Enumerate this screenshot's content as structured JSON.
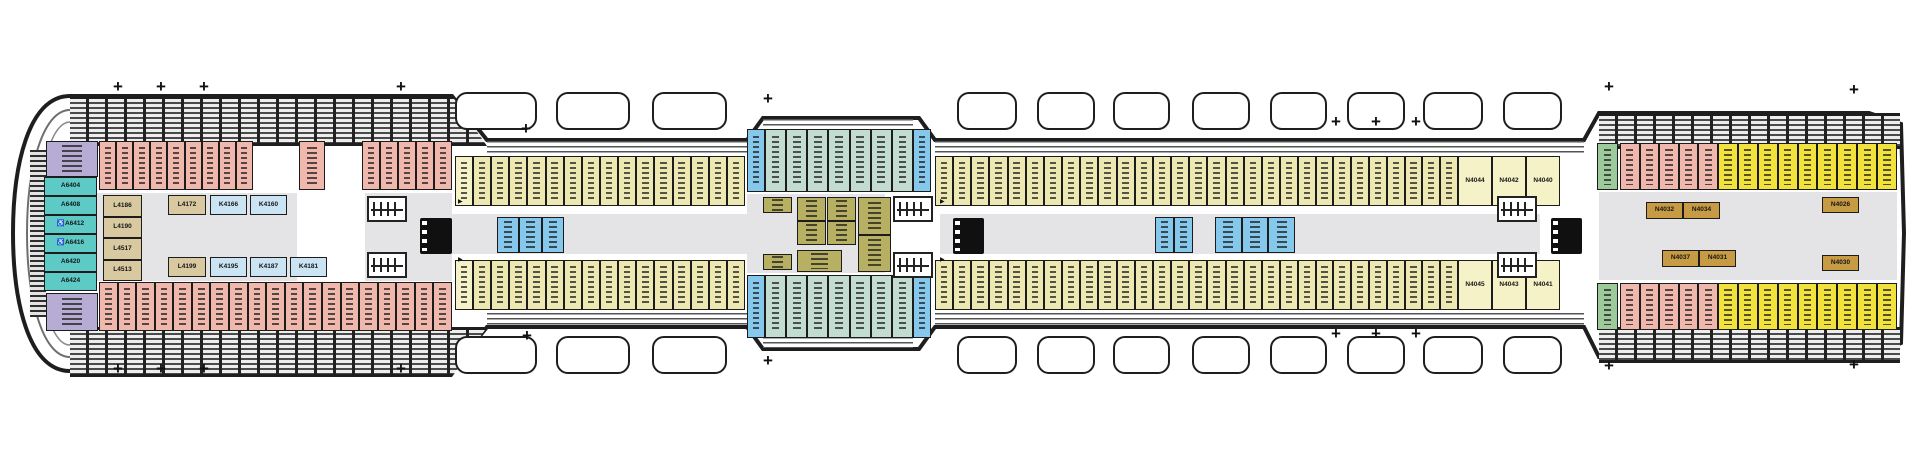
{
  "title": "ship-deck-plan",
  "colors": {
    "pink": "#F0B7AC",
    "khaki": "#EDE8B2",
    "olive": "#B7AF62",
    "tan": "#D8C9A1",
    "kblue": "#CBE4F4",
    "blue": "#86C7EC",
    "paleteal": "#C2DCD2",
    "teal": "#5ECAC6",
    "purple": "#B6ACD4",
    "yellow": "#F1E23C",
    "green": "#9CCA9A",
    "gold": "#C79B44",
    "paleyellow": "#F6F2C8",
    "outline": "#1E1E1E",
    "deck_gray": "#E4E4E6"
  },
  "plan": {
    "sections": [
      {
        "n": "purple-corner-top",
        "x": 46,
        "y": 141,
        "w": 52,
        "h": 36,
        "c": 1,
        "col": "purple"
      },
      {
        "n": "pink-top-a",
        "x": 99,
        "y": 141,
        "w": 154,
        "h": 49,
        "c": 9,
        "col": "pink"
      },
      {
        "n": "pink-top-b",
        "x": 299,
        "y": 141,
        "w": 26,
        "h": 49,
        "c": 1,
        "col": "pink"
      },
      {
        "n": "pink-top-c",
        "x": 362,
        "y": 141,
        "w": 90,
        "h": 49,
        "c": 5,
        "col": "pink"
      },
      {
        "n": "bow-suites",
        "x": 44,
        "y": 177,
        "w": 53,
        "h": 114,
        "c": 6,
        "col": "teal",
        "dir": "col",
        "labels": [
          "A6404",
          "A6408",
          "A6412",
          "A6416",
          "A6420",
          "A6424"
        ],
        "acc": [
          2,
          3
        ]
      },
      {
        "n": "purple-corner-bottom",
        "x": 46,
        "y": 293,
        "w": 52,
        "h": 38,
        "c": 1,
        "col": "purple"
      },
      {
        "n": "pink-bottom",
        "x": 99,
        "y": 282,
        "w": 353,
        "h": 49,
        "c": 19,
        "col": "pink"
      },
      {
        "n": "tan-column",
        "x": 103,
        "y": 195,
        "w": 39,
        "h": 86,
        "c": 4,
        "col": "tan",
        "dir": "col",
        "labels": [
          "L4186",
          "L4190",
          "L4517",
          "L4513"
        ]
      },
      {
        "n": "mid-row-top-1",
        "x": 168,
        "y": 195,
        "w": 38,
        "h": 20,
        "c": 1,
        "col": "tan",
        "labels": [
          "L4172"
        ]
      },
      {
        "n": "mid-row-top-2",
        "x": 210,
        "y": 195,
        "w": 37,
        "h": 20,
        "c": 1,
        "col": "kblue",
        "labels": [
          "K4166"
        ]
      },
      {
        "n": "mid-row-top-3",
        "x": 250,
        "y": 195,
        "w": 37,
        "h": 20,
        "c": 1,
        "col": "kblue",
        "labels": [
          "K4160"
        ]
      },
      {
        "n": "mid-row-bot-1",
        "x": 168,
        "y": 257,
        "w": 38,
        "h": 20,
        "c": 1,
        "col": "tan",
        "labels": [
          "L4199"
        ]
      },
      {
        "n": "mid-row-bot-2",
        "x": 210,
        "y": 257,
        "w": 37,
        "h": 20,
        "c": 1,
        "col": "kblue",
        "labels": [
          "K4195"
        ]
      },
      {
        "n": "mid-row-bot-3",
        "x": 250,
        "y": 257,
        "w": 37,
        "h": 20,
        "c": 1,
        "col": "kblue",
        "labels": [
          "K4187"
        ]
      },
      {
        "n": "mid-row-bot-4",
        "x": 290,
        "y": 257,
        "w": 37,
        "h": 20,
        "c": 1,
        "col": "kblue",
        "labels": [
          "K4181"
        ]
      },
      {
        "n": "plain-top-l",
        "x": 455,
        "y": 156,
        "w": 18,
        "h": 50,
        "c": 1,
        "col": "paleyellow"
      },
      {
        "n": "khaki-top-1",
        "x": 473,
        "y": 156,
        "w": 272,
        "h": 50,
        "c": 15,
        "col": "khaki"
      },
      {
        "n": "bump-cap-tl",
        "x": 747,
        "y": 129,
        "w": 18,
        "h": 63,
        "c": 1,
        "col": "blue"
      },
      {
        "n": "bump-top",
        "x": 765,
        "y": 129,
        "w": 148,
        "h": 63,
        "c": 7,
        "col": "paleteal"
      },
      {
        "n": "bump-cap-tr",
        "x": 913,
        "y": 129,
        "w": 18,
        "h": 63,
        "c": 1,
        "col": "blue"
      },
      {
        "n": "khaki-top-2",
        "x": 935,
        "y": 156,
        "w": 345,
        "h": 50,
        "c": 19,
        "col": "khaki"
      },
      {
        "n": "khaki-top-3",
        "x": 1280,
        "y": 156,
        "w": 178,
        "h": 50,
        "c": 10,
        "col": "khaki"
      },
      {
        "n": "trio-top",
        "x": 1458,
        "y": 156,
        "w": 102,
        "h": 50,
        "c": 3,
        "col": "paleyellow",
        "labels": [
          "N4044",
          "N4042",
          "N4040"
        ]
      },
      {
        "n": "green-top",
        "x": 1597,
        "y": 143,
        "w": 21,
        "h": 47,
        "c": 1,
        "col": "green"
      },
      {
        "n": "stern-pink-top",
        "x": 1620,
        "y": 143,
        "w": 98,
        "h": 47,
        "c": 5,
        "col": "pink"
      },
      {
        "n": "stern-yellow-top",
        "x": 1718,
        "y": 143,
        "w": 179,
        "h": 47,
        "c": 9,
        "col": "yellow"
      },
      {
        "n": "blue-group-1",
        "x": 497,
        "y": 217,
        "w": 67,
        "h": 36,
        "c": 3,
        "col": "blue"
      },
      {
        "n": "olive-small-top",
        "x": 763,
        "y": 197,
        "w": 29,
        "h": 16,
        "c": 1,
        "col": "olive"
      },
      {
        "n": "olive-col-1",
        "x": 797,
        "y": 197,
        "w": 29,
        "h": 48,
        "c": 2,
        "col": "olive",
        "dir": "col"
      },
      {
        "n": "olive-col-2",
        "x": 827,
        "y": 197,
        "w": 29,
        "h": 48,
        "c": 2,
        "col": "olive",
        "dir": "col"
      },
      {
        "n": "olive-tall",
        "x": 858,
        "y": 197,
        "w": 33,
        "h": 75,
        "c": 2,
        "col": "olive",
        "dir": "col"
      },
      {
        "n": "olive-bottom",
        "x": 797,
        "y": 250,
        "w": 45,
        "h": 22,
        "c": 1,
        "col": "olive"
      },
      {
        "n": "olive-small-bot",
        "x": 763,
        "y": 254,
        "w": 29,
        "h": 16,
        "c": 1,
        "col": "olive"
      },
      {
        "n": "blue-group-2",
        "x": 1155,
        "y": 217,
        "w": 38,
        "h": 36,
        "c": 2,
        "col": "blue"
      },
      {
        "n": "blue-group-3",
        "x": 1215,
        "y": 217,
        "w": 80,
        "h": 36,
        "c": 3,
        "col": "blue"
      },
      {
        "n": "gold-pair-top",
        "x": 1646,
        "y": 202,
        "w": 74,
        "h": 17,
        "c": 2,
        "col": "gold",
        "labels": [
          "N4032",
          "N4034"
        ]
      },
      {
        "n": "gold-pair-bot",
        "x": 1662,
        "y": 250,
        "w": 74,
        "h": 17,
        "c": 2,
        "col": "gold",
        "labels": [
          "N4037",
          "N4031"
        ]
      },
      {
        "n": "gold-single-top",
        "x": 1822,
        "y": 197,
        "w": 37,
        "h": 16,
        "c": 1,
        "col": "gold",
        "labels": [
          "N4026"
        ]
      },
      {
        "n": "gold-single-bot",
        "x": 1822,
        "y": 255,
        "w": 37,
        "h": 16,
        "c": 1,
        "col": "gold",
        "labels": [
          "N4030"
        ]
      },
      {
        "n": "plain-bot-l",
        "x": 455,
        "y": 260,
        "w": 18,
        "h": 50,
        "c": 1,
        "col": "paleyellow"
      },
      {
        "n": "khaki-bot-1",
        "x": 473,
        "y": 260,
        "w": 272,
        "h": 50,
        "c": 15,
        "col": "khaki"
      },
      {
        "n": "bump-cap-bl",
        "x": 747,
        "y": 275,
        "w": 18,
        "h": 63,
        "c": 1,
        "col": "blue"
      },
      {
        "n": "bump-bot",
        "x": 765,
        "y": 275,
        "w": 148,
        "h": 63,
        "c": 7,
        "col": "paleteal"
      },
      {
        "n": "bump-cap-br",
        "x": 913,
        "y": 275,
        "w": 18,
        "h": 63,
        "c": 1,
        "col": "blue"
      },
      {
        "n": "khaki-bot-2",
        "x": 935,
        "y": 260,
        "w": 345,
        "h": 50,
        "c": 19,
        "col": "khaki"
      },
      {
        "n": "khaki-bot-3",
        "x": 1280,
        "y": 260,
        "w": 178,
        "h": 50,
        "c": 10,
        "col": "khaki"
      },
      {
        "n": "trio-bot",
        "x": 1458,
        "y": 260,
        "w": 102,
        "h": 50,
        "c": 3,
        "col": "paleyellow",
        "labels": [
          "N4045",
          "N4043",
          "N4041"
        ]
      },
      {
        "n": "green-bot",
        "x": 1597,
        "y": 283,
        "w": 21,
        "h": 47,
        "c": 1,
        "col": "green"
      },
      {
        "n": "stern-pink-bot",
        "x": 1620,
        "y": 283,
        "w": 98,
        "h": 47,
        "c": 5,
        "col": "pink"
      },
      {
        "n": "stern-yellow-bot",
        "x": 1718,
        "y": 283,
        "w": 179,
        "h": 47,
        "c": 9,
        "col": "yellow"
      }
    ],
    "gray_zones": [
      [
        65,
        193,
        387,
        88
      ],
      [
        452,
        214,
        1145,
        40
      ],
      [
        747,
        194,
        188,
        79
      ],
      [
        1599,
        192,
        298,
        88
      ]
    ],
    "white_lobbies": [
      [
        297,
        193,
        68,
        88
      ],
      [
        885,
        194,
        55,
        87
      ],
      [
        1540,
        190,
        57,
        95
      ]
    ],
    "hatch_bands": [
      {
        "x": 70,
        "y": 96,
        "w": 417,
        "h": 44,
        "clip": "polygon(0 0, calc(100% - 35px) 0, 100% 100%, 0 100%)"
      },
      {
        "x": 70,
        "y": 327,
        "w": 417,
        "h": 44,
        "clip": "polygon(0 0, 100% 0, calc(100% - 35px) 100%, 0 100%)"
      },
      {
        "x": 1599,
        "y": 113,
        "w": 301,
        "h": 30,
        "clip": "none"
      },
      {
        "x": 1599,
        "y": 327,
        "w": 301,
        "h": 30,
        "clip": "none"
      }
    ],
    "rails": [
      [
        487,
        141,
        260,
        13
      ],
      [
        935,
        141,
        649,
        13
      ],
      [
        487,
        313,
        260,
        13
      ],
      [
        935,
        313,
        649,
        13
      ],
      [
        763,
        119,
        150,
        11
      ],
      [
        763,
        337,
        150,
        11
      ]
    ],
    "bow_strip": [
      30,
      150,
      16,
      167
    ],
    "stairs": [
      [
        367,
        196
      ],
      [
        367,
        252
      ],
      [
        893,
        196
      ],
      [
        893,
        252
      ],
      [
        1497,
        196
      ],
      [
        1497,
        252
      ]
    ],
    "elevators": [
      [
        420,
        218,
        32,
        36
      ],
      [
        953,
        218,
        31,
        36
      ],
      [
        1551,
        218,
        31,
        36
      ]
    ],
    "arrows": [
      [
        458,
        199
      ],
      [
        458,
        257
      ],
      [
        940,
        199
      ],
      [
        940,
        257
      ]
    ],
    "lifeboats": {
      "y_top": 92,
      "y_bottom": 336,
      "h": 38,
      "boats": [
        [
          455,
          82
        ],
        [
          556,
          74
        ],
        [
          652,
          75
        ],
        [
          957,
          60
        ],
        [
          1037,
          58
        ],
        [
          1113,
          57
        ],
        [
          1192,
          58
        ],
        [
          1270,
          57
        ],
        [
          1347,
          58
        ],
        [
          1423,
          60
        ],
        [
          1503,
          59
        ]
      ]
    },
    "crosses": {
      "glyph": "+",
      "top": [
        [
          118,
          87
        ],
        [
          161,
          87
        ],
        [
          204,
          87
        ],
        [
          401,
          87
        ],
        [
          526,
          129
        ],
        [
          768,
          99
        ],
        [
          1336,
          122
        ],
        [
          1376,
          122
        ],
        [
          1416,
          122
        ],
        [
          1609,
          87
        ],
        [
          1854,
          90
        ]
      ],
      "bottom": [
        [
          118,
          369
        ],
        [
          161,
          369
        ],
        [
          204,
          369
        ],
        [
          401,
          369
        ],
        [
          527,
          336
        ],
        [
          768,
          361
        ],
        [
          1336,
          334
        ],
        [
          1376,
          334
        ],
        [
          1416,
          334
        ],
        [
          1609,
          366
        ],
        [
          1854,
          365
        ]
      ]
    },
    "accessible_glyph": "♿"
  }
}
